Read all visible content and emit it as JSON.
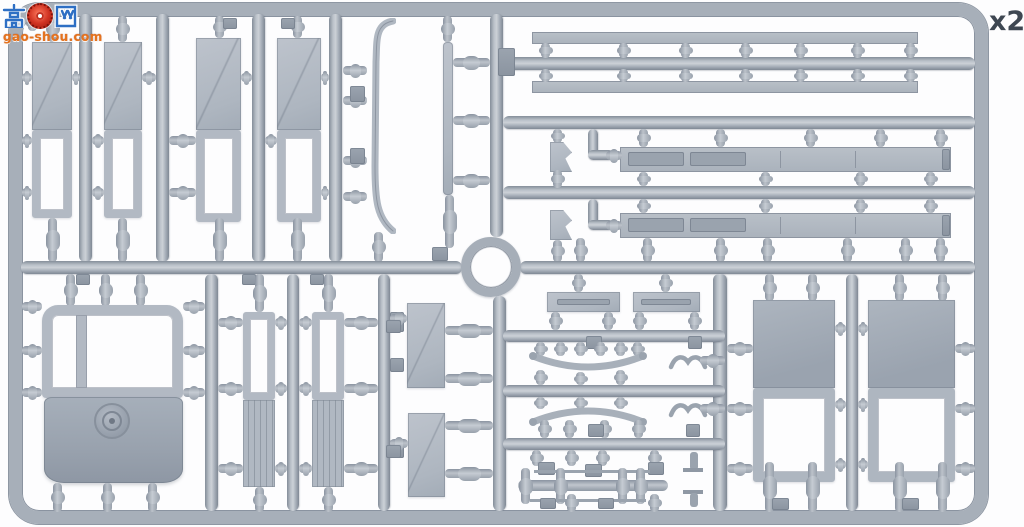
{
  "watermark": {
    "char_left": "高",
    "char_right": "网",
    "badge": "red-gear-emblem",
    "domain": "gao-shou.com"
  },
  "quantity_label": "x2",
  "subject": {
    "type": "model-kit-sprue-photo",
    "part_groups": [
      "hull-side-panels",
      "fender-strip",
      "thin-bar",
      "rail-strips",
      "chassis-girders",
      "sprue-ring",
      "cab-tub-with-boss",
      "ladder-panels",
      "deck-plates",
      "leaf-springs",
      "axle-rod",
      "side-wall-panels"
    ]
  },
  "colors": {
    "plastic": "#a7afb9",
    "plastic-dark": "#8a93a0",
    "plastic-light": "#c6ccd3",
    "part-fill": "#b2b9c3",
    "part-dark": "#99a2ae",
    "background": "#fdfdfe",
    "label": "#3e4752",
    "wm-blue": "#2e6fc4",
    "wm-red": "#c2301f",
    "wm-orange": "#e5731e"
  }
}
